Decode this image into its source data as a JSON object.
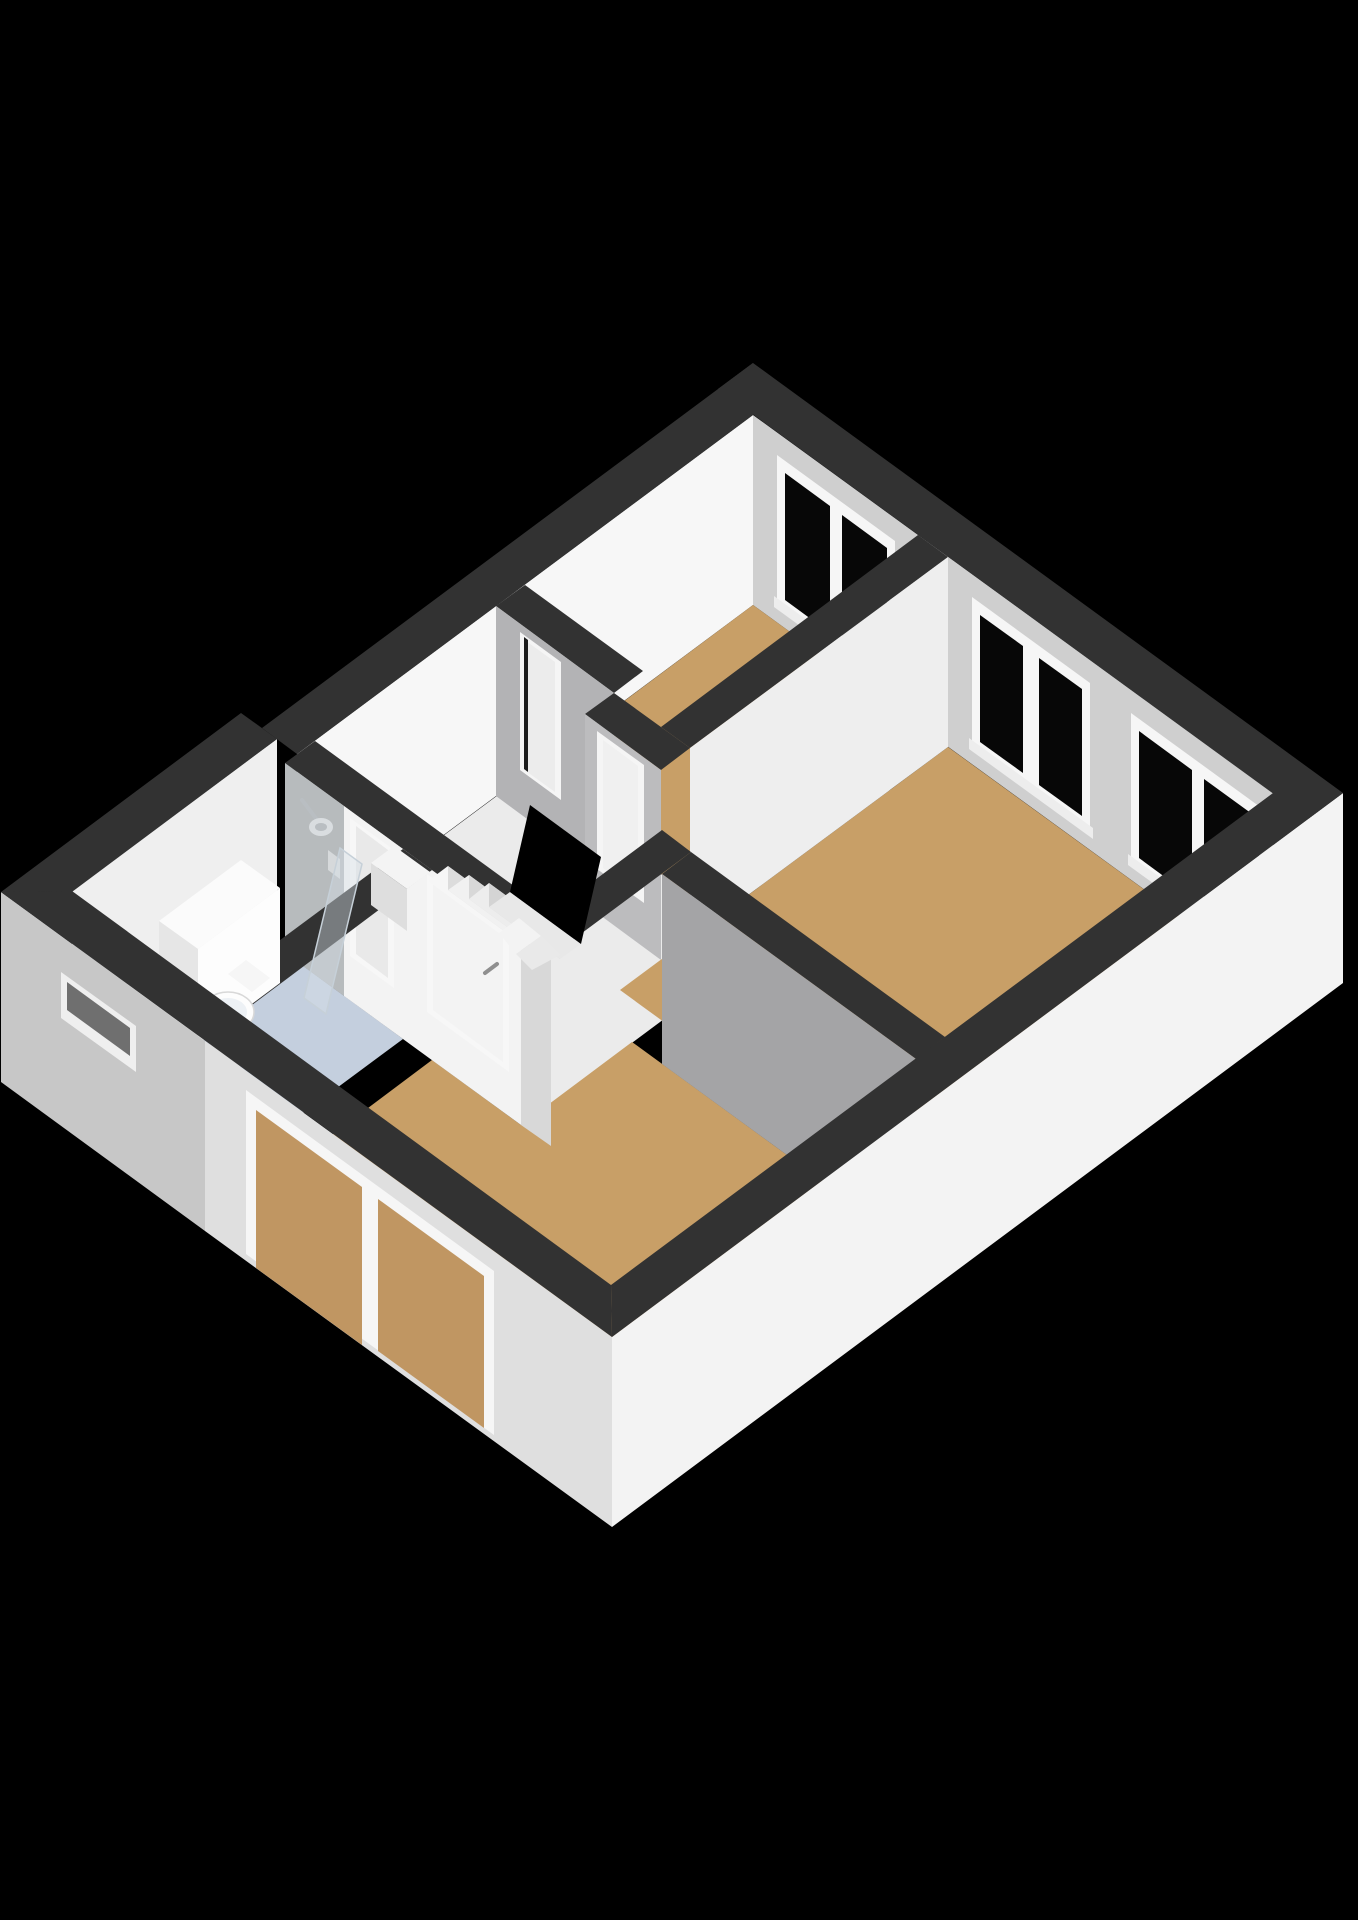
{
  "scene": {
    "type": "floorplan-3d-render",
    "view": "isometric-cutaway-top-floor",
    "background": "#000000",
    "has_text_labels": false
  },
  "colors": {
    "bg": "#000000",
    "wall_top": "#323232",
    "wall_int_white": "#f7f7f7",
    "wall_int_offwhite": "#efefef",
    "wall_int_light": "#cfcfcf",
    "wall_int_soft": "#eeeeee",
    "wall_int_gray": "#b3b3b5",
    "wall_int_gray2": "#bcbcbe",
    "wall_int_darkgray": "#a4a4a6",
    "wall_int_pale": "#d8d8d8",
    "wall_shower_gray": "#b7bbbd",
    "wall_ext_bright": "#f3f3f3",
    "wall_ext_mid": "#dfdfdf",
    "wall_ext_shade": "#c7c7c7",
    "wall_ext_inner": "#e9e9e9",
    "wall_ext_soft": "#e2e2e2",
    "floor_wood": "#c89f67",
    "floor_wood_through_glass": "#c09662",
    "floor_bathroom": "#c4cfde",
    "floor_landing": "#ebebeb",
    "glass_black": "#070707",
    "window_frame": "#f6f6f6",
    "window_sill": "#ededed",
    "slot_outer": "#efefef",
    "slot_inner": "#6f6f6f",
    "stair_tread": "#f6f6f6",
    "stair_tread2": "#f1f1f1",
    "stair_tread3": "#ededed",
    "stair_tread4": "#e8e8e8",
    "stair_riser": "#dcdcdc",
    "stair_riser2": "#d8d8d8",
    "stair_riser3": "#d4d4d4",
    "stair_void": "#000000",
    "stub_top": "#f4f4f4",
    "stub_front": "#dedede",
    "door_frame": "#f5f5f5",
    "door_leaf": "#f0f0f0",
    "door_leaf_light": "#ececec",
    "door_gap": "#1c1c1c",
    "handle_gray": "#8f8f8f",
    "chrome": "#b9bec2",
    "chrome_light": "#d9dde0",
    "fixture_white": "#fdfdfd",
    "fixture_top": "#fbfbfb",
    "fixture_side": "#e6e6e6",
    "toilet_rim": "#edf1f5",
    "toilet_stroke": "#d8d8d8",
    "valve": "#d6d9db",
    "shower_glass": "#d7e0e8",
    "shower_glass_edge": "#c6d0d8"
  },
  "rooms": [
    {
      "name": "bedroom-north",
      "floor": "wood",
      "windows": 1
    },
    {
      "name": "bedroom-east",
      "floor": "wood",
      "windows": 2
    },
    {
      "name": "bedroom-south",
      "floor": "wood",
      "windows": 1
    },
    {
      "name": "bathroom",
      "floor": "light-blue",
      "windows": 1
    },
    {
      "name": "landing",
      "floor": "white",
      "windows": 0
    }
  ],
  "windows": [
    {
      "name": "bedroom-north-window",
      "wall": "north-east",
      "panes": 2,
      "glass": "black"
    },
    {
      "name": "bedroom-east-window-1",
      "wall": "north-east",
      "panes": 2,
      "glass": "black"
    },
    {
      "name": "bedroom-east-window-2",
      "wall": "north-east",
      "panes": 2,
      "glass": "black"
    },
    {
      "name": "bedroom-south-window",
      "wall": "south-west",
      "panes": 2,
      "glass": "transparent-shows-floor"
    },
    {
      "name": "bathroom-slot-window",
      "wall": "south-west",
      "panes": 1,
      "glass": "recessed"
    }
  ],
  "doors": [
    {
      "name": "door-bedroom-north",
      "state": "ajar"
    },
    {
      "name": "door-bedroom-east",
      "state": "closed"
    },
    {
      "name": "door-bedroom-south",
      "state": "closed",
      "handle": true
    },
    {
      "name": "door-bathroom",
      "state": "closed"
    }
  ],
  "fixtures": [
    {
      "name": "staircase",
      "treads_visible": 4,
      "winders": 2,
      "stairwell_void": true
    },
    {
      "name": "toilet"
    },
    {
      "name": "bathroom-cabinet"
    },
    {
      "name": "shower-head"
    },
    {
      "name": "shower-valve"
    },
    {
      "name": "shower-glass-screen"
    }
  ]
}
